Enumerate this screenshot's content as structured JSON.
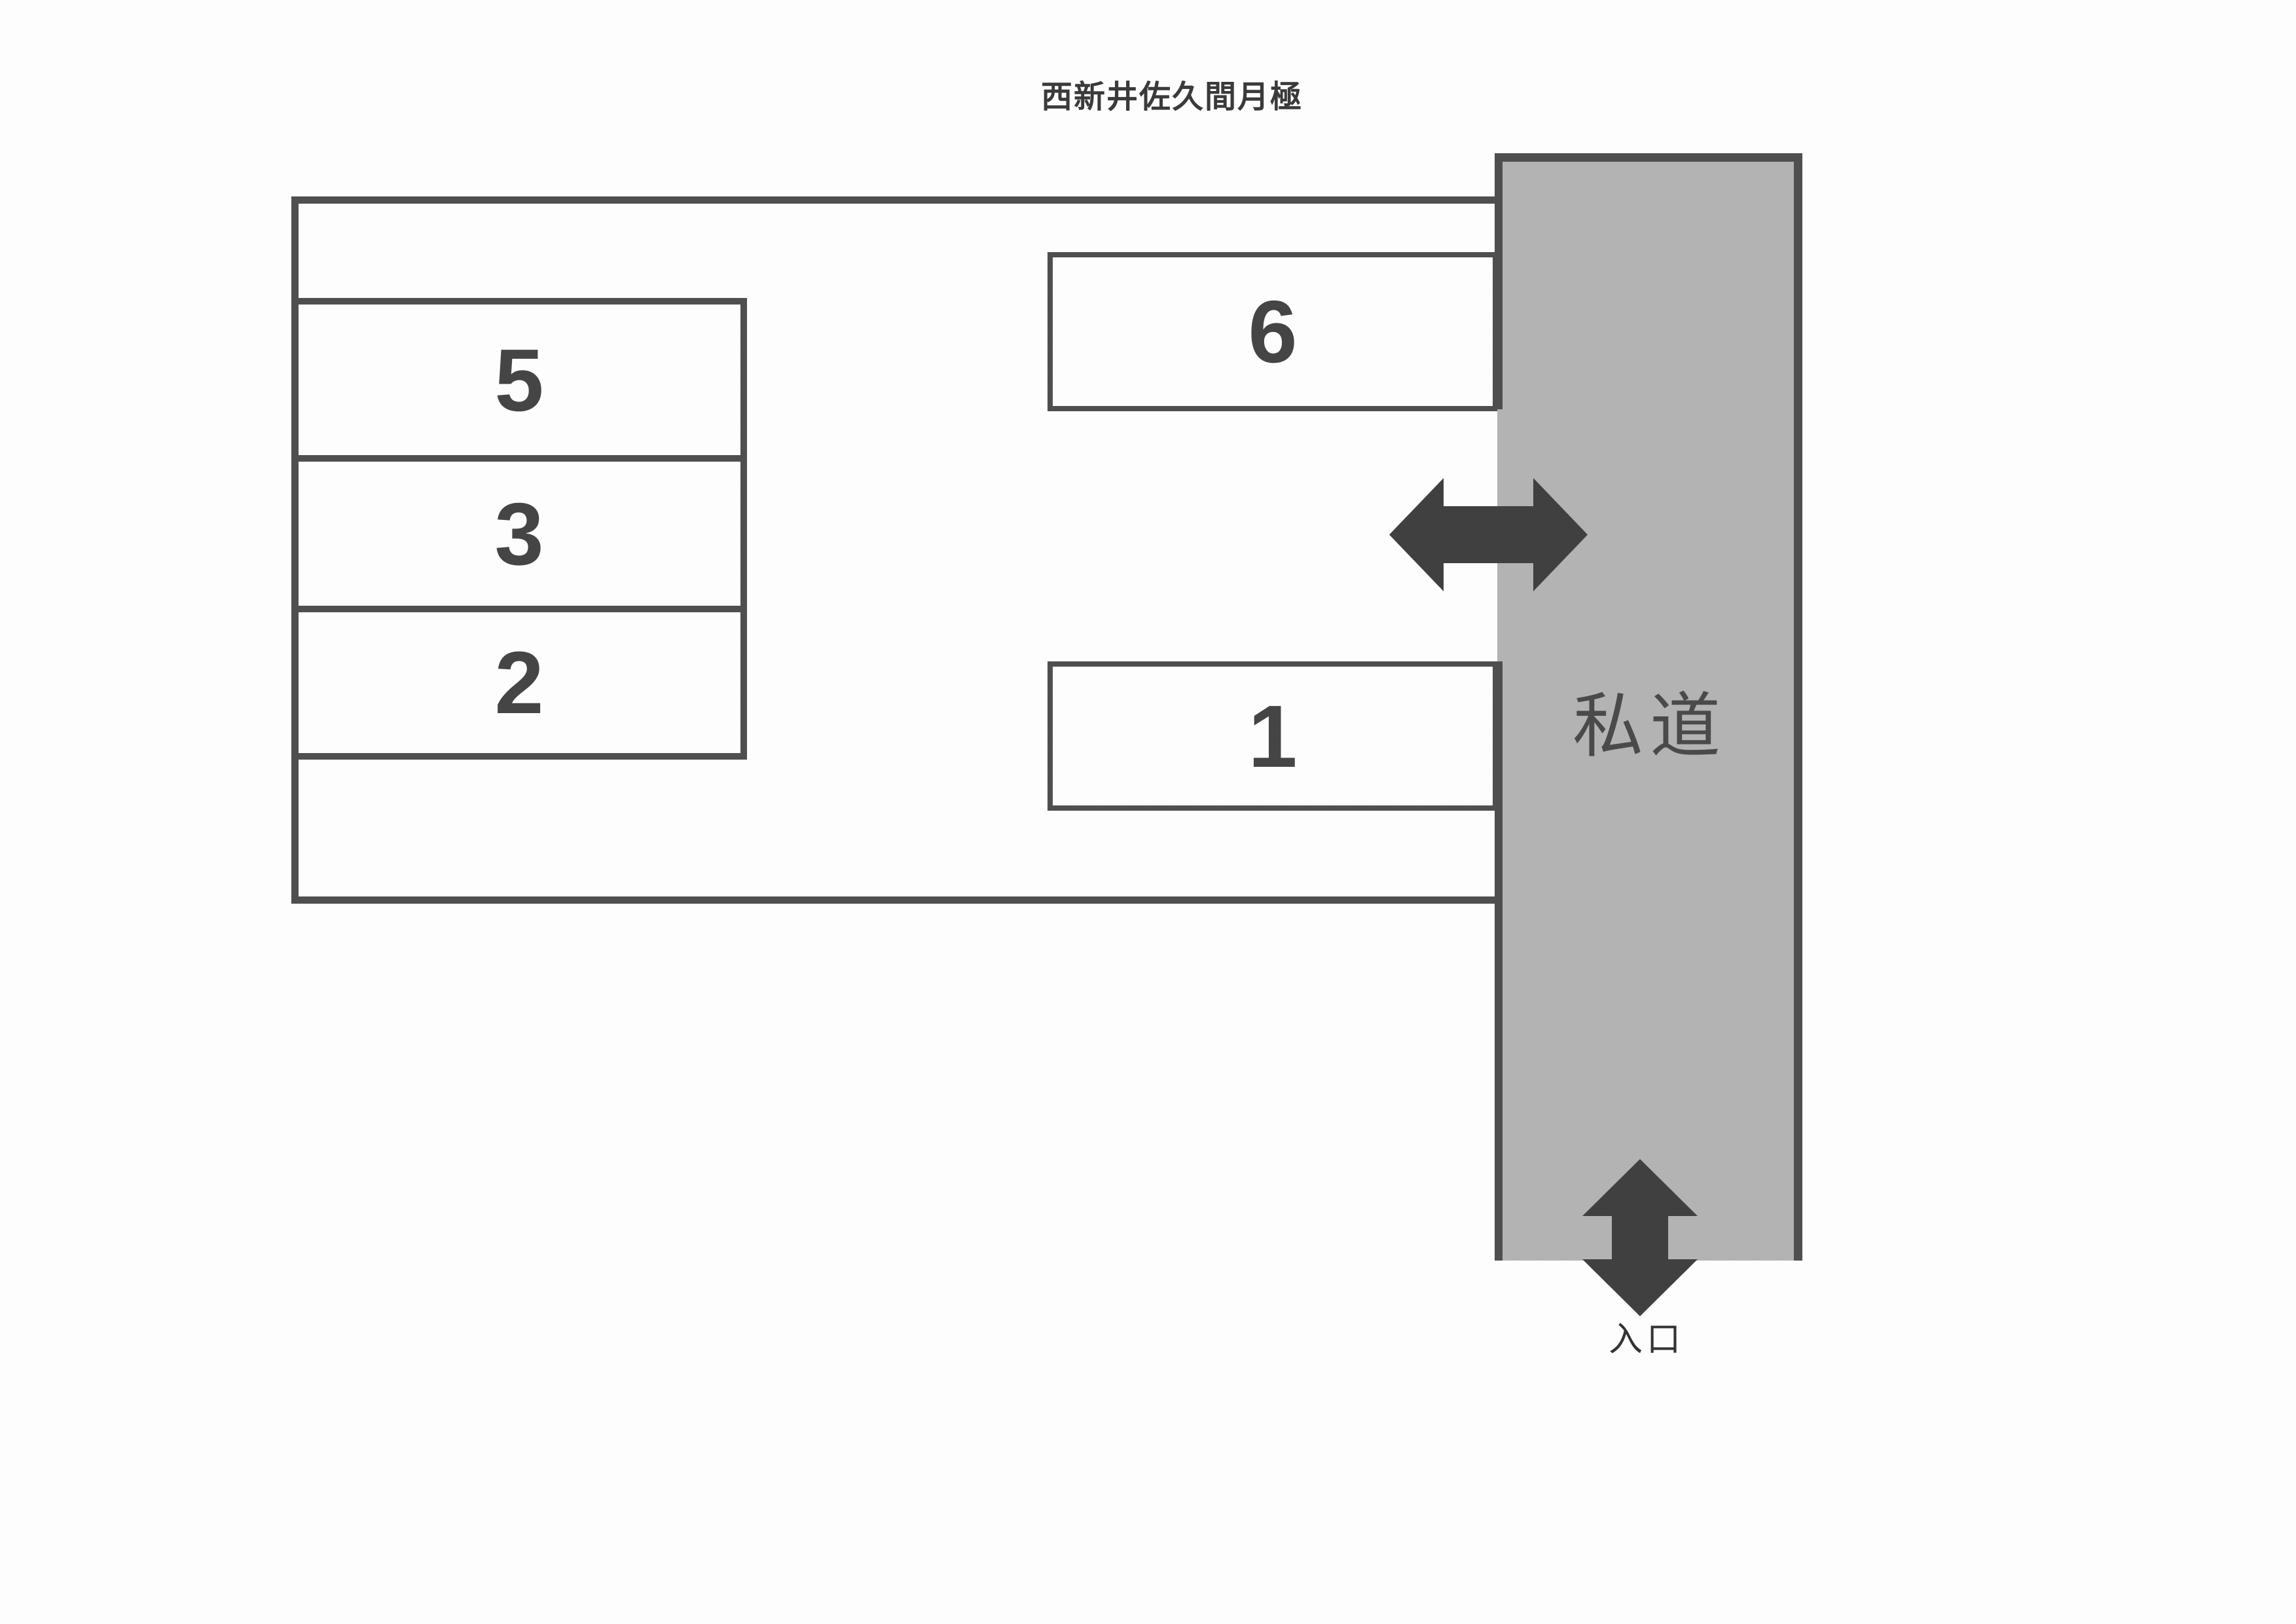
{
  "title": "西新井佐久間月極",
  "lot": {
    "spaces": [
      {
        "label": "5"
      },
      {
        "label": "3"
      },
      {
        "label": "2"
      },
      {
        "label": "6"
      },
      {
        "label": "1"
      }
    ]
  },
  "road": {
    "label": "私道"
  },
  "entrance": {
    "label": "入口"
  },
  "icons": {
    "horizontal_arrow": "double-arrow-horizontal-icon",
    "vertical_arrow": "double-arrow-vertical-icon"
  },
  "colors": {
    "line": "#4f4f4f",
    "arrow": "#404040",
    "road_fill": "#b3b3b3",
    "text": "#3a3a3a",
    "digit": "#454545",
    "paper": "#fdfdfd"
  }
}
